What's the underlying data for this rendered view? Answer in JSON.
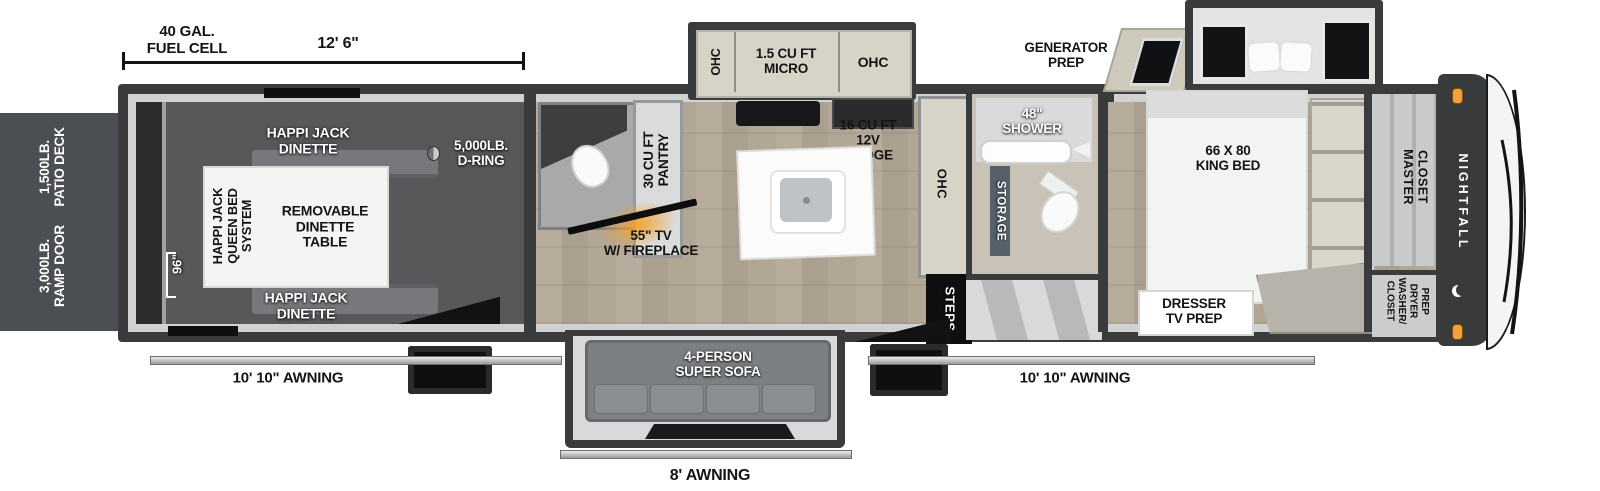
{
  "dims": {
    "fuel_cell": "40 GAL.\nFUEL CELL",
    "length": "12' 6\"",
    "garage_width": "96\"",
    "awning_left": "10' 10\" AWNING",
    "awning_right": "10' 10\" AWNING",
    "awning_rear": "8' AWNING"
  },
  "exterior": {
    "patio_deck": "1,500LB.\nPATIO DECK",
    "ramp_door": "3,000LB.\nRAMP DOOR",
    "generator": "GENERATOR\nPREP",
    "brand": "NIGHTFALL"
  },
  "garage": {
    "dinette_top": "HAPPI JACK\nDINETTE",
    "dinette_bottom": "HAPPI JACK\nDINETTE",
    "bed_system": "HAPPI JACK\nQUEEN BED\nSYSTEM",
    "table": "REMOVABLE\nDINETTE\nTABLE",
    "d_ring": "5,000LB.\nD-RING"
  },
  "kitchen": {
    "ohc_left": "OHC",
    "micro": "1.5 CU FT\nMICRO",
    "ohc_right": "OHC",
    "fridge": "16 CU FT\n12V\nFRIDGE",
    "pantry": "30 CU FT\nPANTRY",
    "tv_fireplace": "55\" TV\nW/ FIREPLACE",
    "ohc_tall": "OHC",
    "steps": "STEPS",
    "sofa": "4-PERSON\nSUPER SOFA"
  },
  "bath": {
    "shower": "48\"\nSHOWER",
    "storage": "STORAGE"
  },
  "bedroom": {
    "king_bed": "66 X 80\nKING BED",
    "dresser": "DRESSER\nTV PREP",
    "master_closet": "MASTER\nCLOSET",
    "washer_dryer": "CLOSET\nWASHER/\nDRYER\nPREP"
  },
  "colors": {
    "wall_dark": "#3a3b3d",
    "panel_gray": "#4b4f53",
    "cabinet_beige": "#d6d3c7",
    "floor_wood": "#b3a696",
    "fireplace_orange": "#f09a2a",
    "marker_light_orange": "#f2a13c"
  }
}
